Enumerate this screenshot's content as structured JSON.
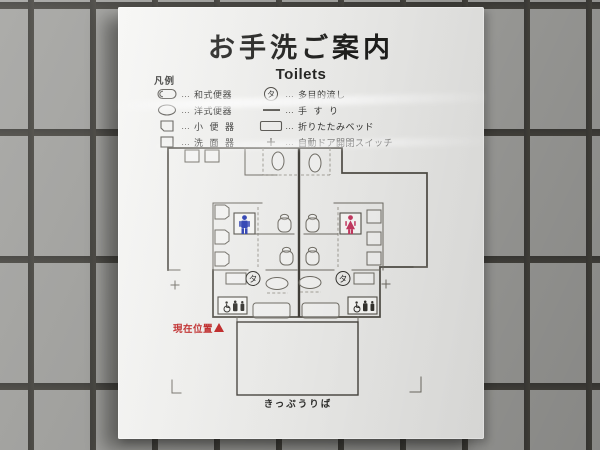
{
  "sign": {
    "title": "お手洗ご案内",
    "subtitle": "Toilets",
    "legend": {
      "heading": "凡例",
      "dots": "…",
      "left": [
        {
          "label": "和式便器"
        },
        {
          "label": "洋式便器"
        },
        {
          "label": "小 便 器"
        },
        {
          "label": "洗 面 器"
        }
      ],
      "right": [
        {
          "symbol": "タ",
          "label": "多目的流し"
        },
        {
          "label": "手 す り"
        },
        {
          "label": "折りたたみベッド"
        },
        {
          "label": "自動ドア開閉スイッチ"
        }
      ]
    },
    "map": {
      "ta_symbol": "タ",
      "current_location": "現在位置",
      "ticket_office": "きっぷうりば",
      "colors": {
        "male_icon": "#2a3eb4",
        "female_icon": "#c63a62",
        "current_location_text": "#bf1f1f",
        "plan_line": "#504d46"
      }
    }
  }
}
